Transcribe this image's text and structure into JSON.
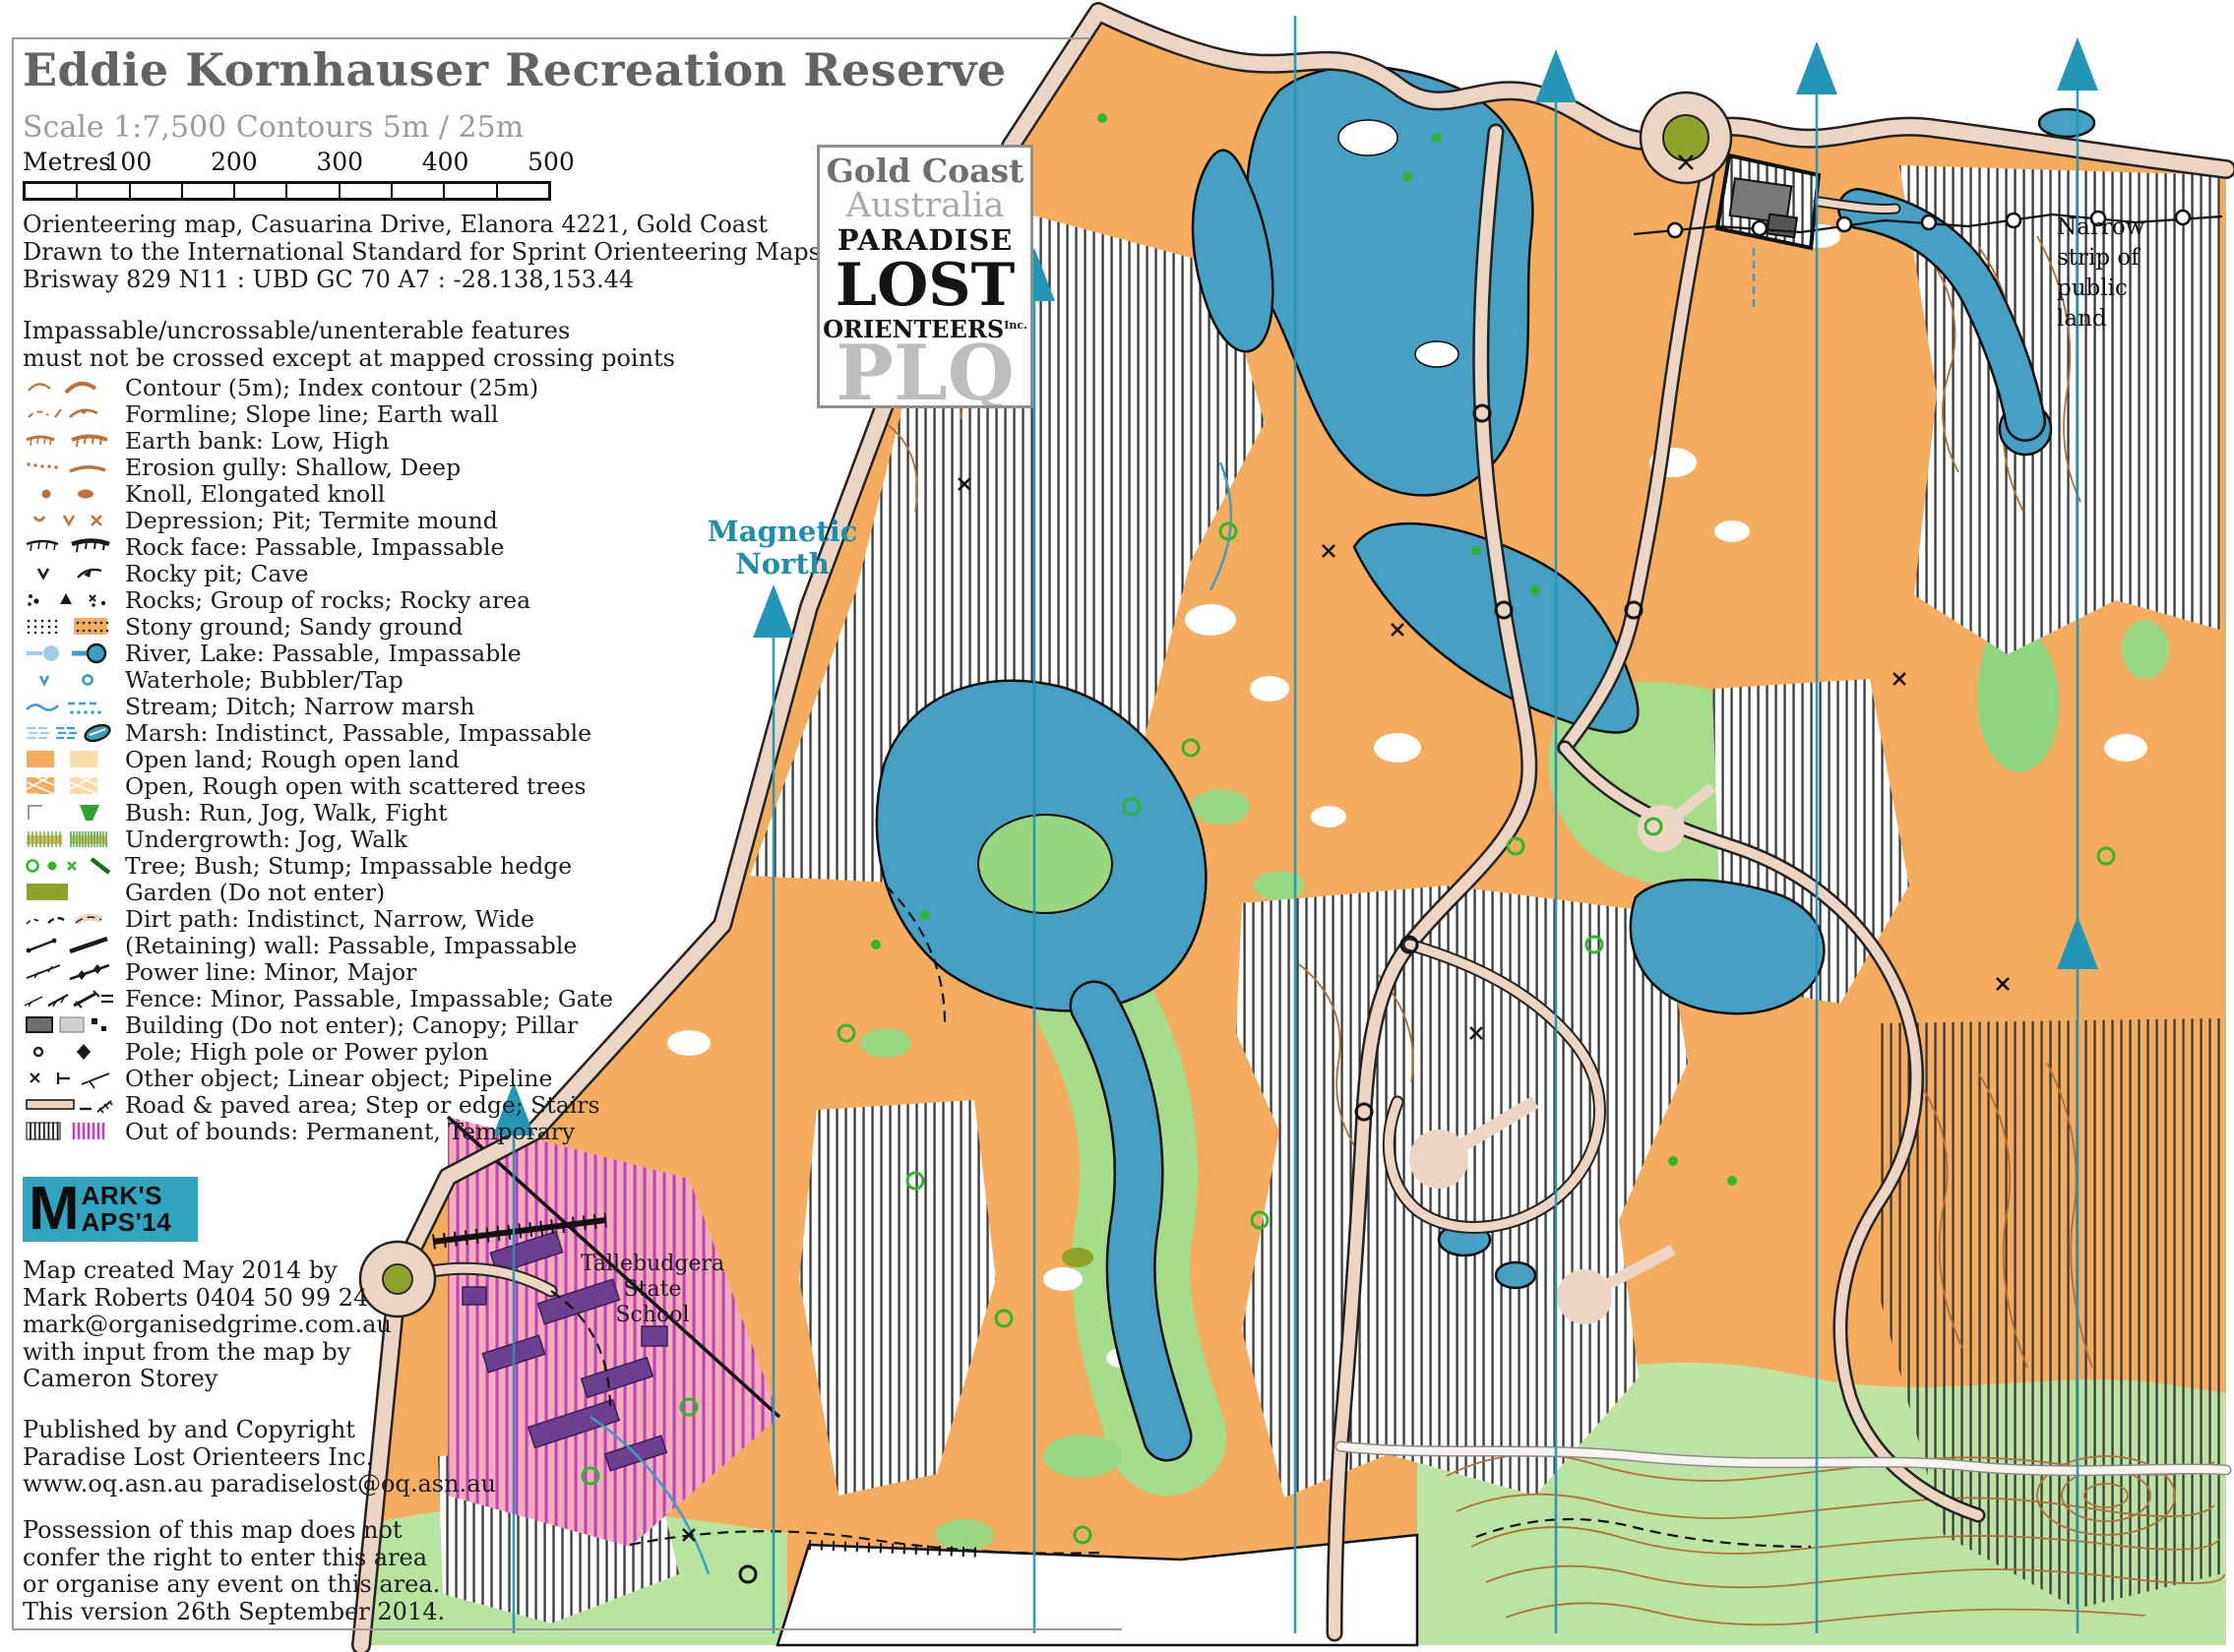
{
  "header": {
    "title": "Eddie Kornhauser Recreation Reserve",
    "scale_line": "Scale 1:7,500  Contours 5m / 25m",
    "scalebar": {
      "unit_label": "Metres",
      "ticks": [
        "100",
        "200",
        "300",
        "400",
        "500"
      ],
      "cells": 10
    },
    "info_lines": [
      "Orienteering map, Casuarina Drive, Elanora 4221, Gold Coast",
      "Drawn to the International Standard for Sprint Orienteering Maps ISSOM 2007",
      "Brisway 829 N11 : UBD GC 70 A7 : -28.138,153.44"
    ],
    "note_lines": [
      "Impassable/uncrossable/unenterable features",
      "must not be crossed except at mapped crossing points"
    ]
  },
  "legend": {
    "items": [
      {
        "icon": "contour-icon",
        "label": "Contour (5m); Index contour (25m)"
      },
      {
        "icon": "formline-icon",
        "label": "Formline; Slope line; Earth wall"
      },
      {
        "icon": "earth-bank-icon",
        "label": "Earth bank: Low, High"
      },
      {
        "icon": "erosion-gully-icon",
        "label": "Erosion gully: Shallow, Deep"
      },
      {
        "icon": "knoll-icon",
        "label": "Knoll, Elongated knoll"
      },
      {
        "icon": "depression-icon",
        "label": "Depression; Pit; Termite mound"
      },
      {
        "icon": "rock-face-icon",
        "label": "Rock face: Passable, Impassable"
      },
      {
        "icon": "rocky-pit-icon",
        "label": "Rocky pit; Cave"
      },
      {
        "icon": "rocks-icon",
        "label": "Rocks; Group of rocks; Rocky area"
      },
      {
        "icon": "stony-ground-icon",
        "label": "Stony ground; Sandy ground"
      },
      {
        "icon": "river-lake-icon",
        "label": "River, Lake: Passable, Impassable"
      },
      {
        "icon": "waterhole-icon",
        "label": "Waterhole; Bubbler/Tap"
      },
      {
        "icon": "stream-icon",
        "label": "Stream; Ditch; Narrow marsh"
      },
      {
        "icon": "marsh-icon",
        "label": "Marsh: Indistinct, Passable, Impassable"
      },
      {
        "icon": "open-land-icon",
        "label": "Open land; Rough open land"
      },
      {
        "icon": "open-scattered-icon",
        "label": "Open, Rough open with scattered trees"
      },
      {
        "icon": "bush-icon",
        "label": "Bush: Run, Jog, Walk, Fight"
      },
      {
        "icon": "undergrowth-icon",
        "label": "Undergrowth: Jog, Walk"
      },
      {
        "icon": "tree-icon",
        "label": "Tree; Bush; Stump; Impassable hedge"
      },
      {
        "icon": "garden-icon",
        "label": "Garden (Do not enter)"
      },
      {
        "icon": "dirt-path-icon",
        "label": "Dirt path: Indistinct, Narrow, Wide"
      },
      {
        "icon": "wall-icon",
        "label": "(Retaining) wall: Passable, Impassable"
      },
      {
        "icon": "power-line-icon",
        "label": "Power line: Minor, Major"
      },
      {
        "icon": "fence-icon",
        "label": "Fence: Minor, Passable, Impassable; Gate"
      },
      {
        "icon": "building-icon",
        "label": "Building (Do not enter); Canopy; Pillar"
      },
      {
        "icon": "pole-icon",
        "label": "Pole; High pole or Power pylon"
      },
      {
        "icon": "other-object-icon",
        "label": "Other object; Linear object; Pipeline"
      },
      {
        "icon": "road-icon",
        "label": "Road & paved area; Step or edge; Stairs"
      },
      {
        "icon": "out-of-bounds-icon",
        "label": "Out of bounds: Permanent, Temporary"
      }
    ]
  },
  "club_logo": {
    "line1": "Gold Coast",
    "line2": "Australia",
    "line3": "PARADISE",
    "line4": "LOST",
    "line5": "ORIENTEERS",
    "line5_suffix": "Inc.",
    "line6": "PLQ"
  },
  "marks_logo": {
    "big_letter": "M",
    "top": "ARK'S",
    "bottom": "APS'14"
  },
  "credits": {
    "lines": [
      "Map created May 2014 by",
      "Mark Roberts  0404 50 99 24",
      "mark@organisedgrime.com.au",
      "with input from the map by",
      "Cameron Storey"
    ]
  },
  "publisher": {
    "lines": [
      "Published by and Copyright",
      "Paradise Lost Orienteers Inc.",
      "www.oq.asn.au  paradiselost@oq.asn.au"
    ]
  },
  "disclaimer": {
    "lines": [
      "Possession of this map does not",
      "confer the right to enter this area",
      "or organise any event on this area.",
      "This version 26th September 2014."
    ]
  },
  "map_labels": {
    "magnetic_north": [
      "Magnetic",
      "North"
    ],
    "school": [
      "Tallebudgera",
      "State",
      "School"
    ],
    "public_land": [
      "Narrow",
      "strip of",
      "public",
      "land"
    ]
  },
  "colors": {
    "open_land": "#F6AC5E",
    "rough_open": "#FBDCA8",
    "lake_blue": "#45A0C4",
    "pale_green": "#BDE3A3",
    "mid_green": "#A6DD8B",
    "contour_brown": "#B07038",
    "teal_north": "#2296B6",
    "road_tan": "#EDD5C3",
    "garden_olive": "#8FA229",
    "out_of_bounds_temporary": "#C23FC2",
    "marks_logo_teal": "#2FA5C0"
  }
}
